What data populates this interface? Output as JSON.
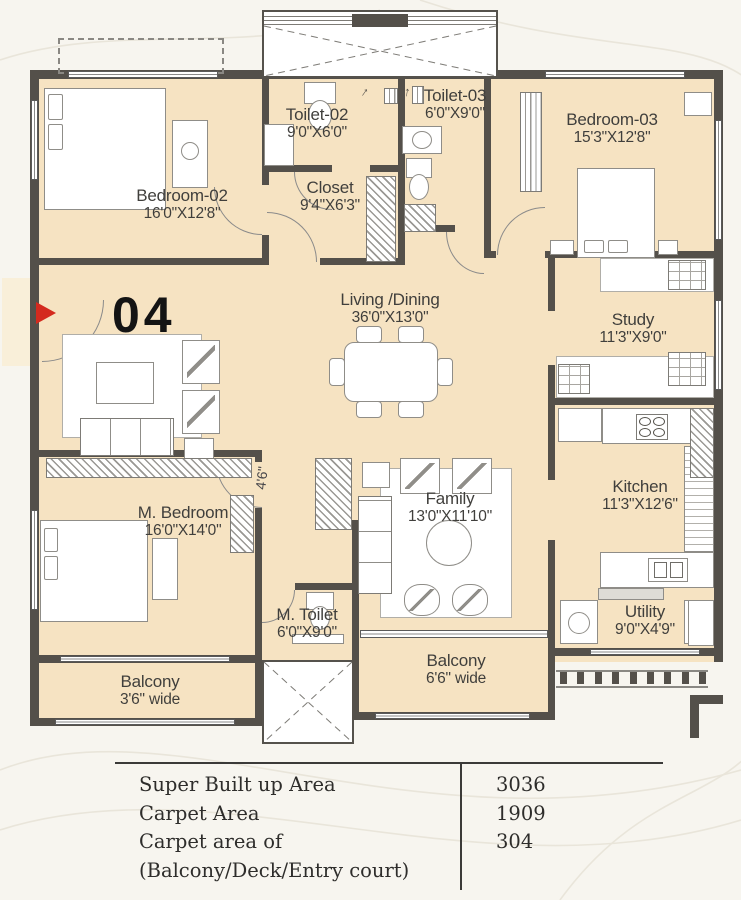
{
  "unit": {
    "number": "04"
  },
  "rooms": [
    {
      "id": "bedroom-02",
      "name": "Bedroom-02",
      "dims": "16'0\"X12'8\""
    },
    {
      "id": "toilet-02",
      "name": "Toilet-02",
      "dims": "9'0\"X6'0\""
    },
    {
      "id": "toilet-03",
      "name": "Toilet-03",
      "dims": "6'0\"X9'0\""
    },
    {
      "id": "closet",
      "name": "Closet",
      "dims": "9'4\"X6'3\""
    },
    {
      "id": "bedroom-03",
      "name": "Bedroom-03",
      "dims": "15'3\"X12'8\""
    },
    {
      "id": "living-dining",
      "name": "Living /Dining",
      "dims": "36'0\"X13'0\""
    },
    {
      "id": "study",
      "name": "Study",
      "dims": "11'3\"X9'0\""
    },
    {
      "id": "kitchen",
      "name": "Kitchen",
      "dims": "11'3\"X12'6\""
    },
    {
      "id": "m-bedroom",
      "name": "M. Bedroom",
      "dims": "16'0\"X14'0\""
    },
    {
      "id": "family",
      "name": "Family",
      "dims": "13'0\"X11'10\""
    },
    {
      "id": "m-toilet",
      "name": "M. Toilet",
      "dims": "6'0\"X9'0\""
    },
    {
      "id": "utility",
      "name": "Utility",
      "dims": "9'0\"X4'9\""
    },
    {
      "id": "balcony-left",
      "name": "Balcony",
      "dims": "3'6\" wide"
    },
    {
      "id": "balcony-center",
      "name": "Balcony",
      "dims": "6'6\" wide"
    }
  ],
  "annotations": {
    "passage_width": "4'6\""
  },
  "area_table": {
    "rows": [
      {
        "label": "Super Built up Area",
        "value": "3036"
      },
      {
        "label": "Carpet Area",
        "value": "1909"
      },
      {
        "label": "Carpet area of",
        "label2": "(Balcony/Deck/Entry court)",
        "value": "304"
      }
    ]
  },
  "colors": {
    "room_fill": "#F6E3C2",
    "wall": "#54504A",
    "background": "#F7F5EF",
    "entry_arrow": "#D42A1E",
    "text": "#403F3C"
  }
}
